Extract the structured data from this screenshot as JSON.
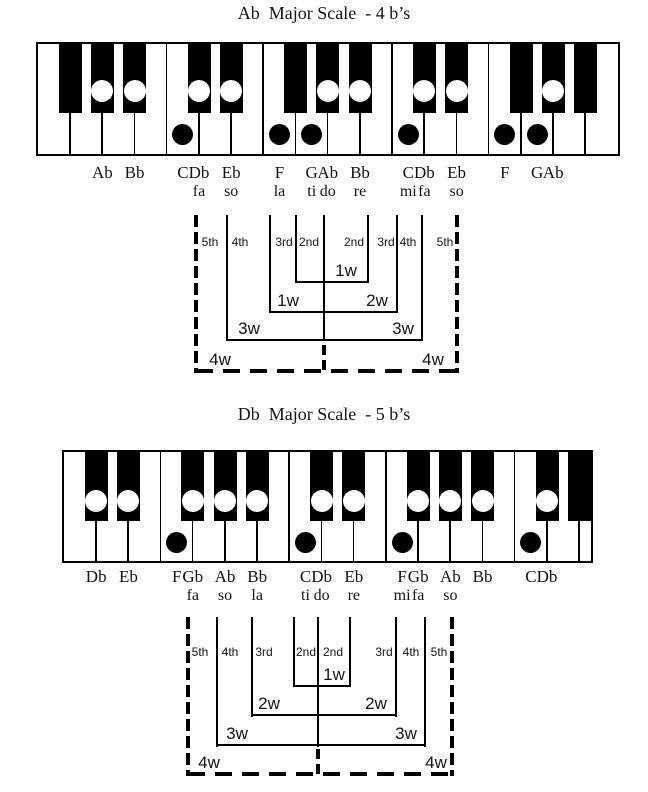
{
  "page": {
    "width": 648,
    "height": 792,
    "background": "#ffffff",
    "ink": "#000000"
  },
  "diagrams": [
    {
      "id": "ab-major",
      "title": "Ab  Major Scale  - 4 b’s",
      "title_y": 4,
      "keyboard": {
        "x": 36,
        "y": 42,
        "width": 584,
        "height": 114,
        "white_key_width": 32.2,
        "black_key_width": 23,
        "black_key_height": 69,
        "circle_cy": 47,
        "dot_cy": 90,
        "label_y": 164,
        "solfege_y": 184,
        "white_keys": [
          {
            "note": "F"
          },
          {
            "note": "G"
          },
          {
            "note": "A"
          },
          {
            "note": "B"
          },
          {
            "note": "C",
            "dot": true,
            "label": "C"
          },
          {
            "note": "D"
          },
          {
            "note": "E"
          },
          {
            "note": "F",
            "dot": true,
            "label": "F",
            "solfege": "la"
          },
          {
            "note": "G",
            "dot": true,
            "label": "G",
            "solfege": "ti"
          },
          {
            "note": "A"
          },
          {
            "note": "B"
          },
          {
            "note": "C",
            "dot": true,
            "label": "C",
            "solfege": "mi"
          },
          {
            "note": "D"
          },
          {
            "note": "E"
          },
          {
            "note": "F",
            "dot": true,
            "label": "F"
          },
          {
            "note": "G",
            "dot": true,
            "label": "G"
          },
          {
            "note": "A"
          },
          {
            "note": "B"
          }
        ],
        "black_keys": [
          {
            "boundary": 1,
            "note": "Gb",
            "circle": false
          },
          {
            "boundary": 2,
            "note": "Ab",
            "circle": true,
            "label": "Ab"
          },
          {
            "boundary": 3,
            "note": "Bb",
            "circle": true,
            "label": "Bb"
          },
          {
            "boundary": 5,
            "note": "Db",
            "circle": true,
            "label": "Db",
            "solfege": "fa"
          },
          {
            "boundary": 6,
            "note": "Eb",
            "circle": true,
            "label": "Eb",
            "solfege": "so"
          },
          {
            "boundary": 8,
            "note": "Gb",
            "circle": false
          },
          {
            "boundary": 9,
            "note": "Ab",
            "circle": true,
            "label": "Ab",
            "solfege": "do"
          },
          {
            "boundary": 10,
            "note": "Bb",
            "circle": true,
            "label": "Bb",
            "solfege": "re"
          },
          {
            "boundary": 12,
            "note": "Db",
            "circle": true,
            "label": "Db",
            "solfege": "fa"
          },
          {
            "boundary": 13,
            "note": "Eb",
            "circle": true,
            "label": "Eb",
            "solfege": "so"
          },
          {
            "boundary": 15,
            "note": "Gb",
            "circle": false
          },
          {
            "boundary": 16,
            "note": "Ab",
            "circle": true,
            "label": "Ab"
          },
          {
            "boundary": 17,
            "note": "Bb",
            "circle": false
          }
        ]
      },
      "intervals": {
        "top": 215,
        "label_y": 236,
        "verticals": [
          {
            "x": 196,
            "to": 373,
            "dashed": true
          },
          {
            "x": 227,
            "to": 341
          },
          {
            "x": 270,
            "to": 313
          },
          {
            "x": 296,
            "to": 283
          },
          {
            "x": 324,
            "to": 341,
            "center": true
          },
          {
            "x": 368,
            "to": 283
          },
          {
            "x": 397,
            "to": 313
          },
          {
            "x": 422,
            "to": 341
          },
          {
            "x": 457,
            "to": 373,
            "dashed": true
          }
        ],
        "center_dash": {
          "x": 324,
          "from": 345,
          "to": 373
        },
        "brackets": [
          {
            "y": 282,
            "x1": 296,
            "x2": 369,
            "labels": [
              {
                "text": "1w",
                "x": 346
              }
            ]
          },
          {
            "y": 312,
            "x1": 270,
            "x2": 398,
            "labels": [
              {
                "text": "1w",
                "x": 288
              },
              {
                "text": "2w",
                "x": 377
              }
            ]
          },
          {
            "y": 340,
            "x1": 227,
            "x2": 423,
            "labels": [
              {
                "text": "3w",
                "x": 249
              },
              {
                "text": "3w",
                "x": 403
              }
            ]
          },
          {
            "y": 371,
            "x1": 196,
            "x2": 459,
            "dashed": true,
            "labels": [
              {
                "text": "4w",
                "x": 220
              },
              {
                "text": "4w",
                "x": 433
              }
            ]
          }
        ],
        "interval_labels": [
          {
            "text": "5th",
            "x": 210
          },
          {
            "text": "4th",
            "x": 240
          },
          {
            "text": "3rd",
            "x": 284
          },
          {
            "text": "2nd",
            "x": 309
          },
          {
            "text": "2nd",
            "x": 354
          },
          {
            "text": "3rd",
            "x": 386
          },
          {
            "text": "4th",
            "x": 408
          },
          {
            "text": "5th",
            "x": 445
          }
        ]
      }
    },
    {
      "id": "db-major",
      "title": "Db  Major Scale  - 5 b’s",
      "title_y": 405,
      "keyboard": {
        "x": 62,
        "y": 450,
        "width": 531,
        "height": 113,
        "white_key_width": 32.2,
        "black_key_width": 23,
        "black_key_height": 69,
        "circle_cy": 49,
        "dot_cy": 90,
        "label_y": 568,
        "solfege_y": 588,
        "white_keys": [
          {
            "note": "C"
          },
          {
            "note": "D"
          },
          {
            "note": "E"
          },
          {
            "note": "F",
            "dot": true,
            "label": "F"
          },
          {
            "note": "G"
          },
          {
            "note": "A"
          },
          {
            "note": "B"
          },
          {
            "note": "C",
            "dot": true,
            "label": "C",
            "solfege": "ti"
          },
          {
            "note": "D"
          },
          {
            "note": "E"
          },
          {
            "note": "F",
            "dot": true,
            "label": "F",
            "solfege": "mi"
          },
          {
            "note": "G"
          },
          {
            "note": "A"
          },
          {
            "note": "B"
          },
          {
            "note": "C",
            "dot": true,
            "label": "C"
          },
          {
            "note": "D"
          },
          {
            "note": "E"
          }
        ],
        "black_keys": [
          {
            "boundary": 1,
            "note": "Db",
            "circle": true,
            "label": "Db"
          },
          {
            "boundary": 2,
            "note": "Eb",
            "circle": true,
            "label": "Eb"
          },
          {
            "boundary": 4,
            "note": "Gb",
            "circle": true,
            "label": "Gb",
            "solfege": "fa"
          },
          {
            "boundary": 5,
            "note": "Ab",
            "circle": true,
            "label": "Ab",
            "solfege": "so"
          },
          {
            "boundary": 6,
            "note": "Bb",
            "circle": true,
            "label": "Bb",
            "solfege": "la"
          },
          {
            "boundary": 8,
            "note": "Db",
            "circle": true,
            "label": "Db",
            "solfege": "do"
          },
          {
            "boundary": 9,
            "note": "Eb",
            "circle": true,
            "label": "Eb",
            "solfege": "re"
          },
          {
            "boundary": 11,
            "note": "Gb",
            "circle": true,
            "label": "Gb",
            "solfege": "fa"
          },
          {
            "boundary": 12,
            "note": "Ab",
            "circle": true,
            "label": "Ab",
            "solfege": "so"
          },
          {
            "boundary": 13,
            "note": "Bb",
            "circle": true,
            "label": "Bb"
          },
          {
            "boundary": 15,
            "note": "Db",
            "circle": true,
            "label": "Db"
          },
          {
            "boundary": 16,
            "note": "Eb",
            "circle": false
          }
        ]
      },
      "intervals": {
        "top": 617,
        "label_y": 646,
        "verticals": [
          {
            "x": 188,
            "to": 776,
            "dashed": true
          },
          {
            "x": 217,
            "to": 747
          },
          {
            "x": 252,
            "to": 717
          },
          {
            "x": 294,
            "to": 687
          },
          {
            "x": 318,
            "to": 747,
            "center": true
          },
          {
            "x": 350,
            "to": 687
          },
          {
            "x": 396,
            "to": 717
          },
          {
            "x": 425,
            "to": 747
          },
          {
            "x": 452,
            "to": 776,
            "dashed": true
          }
        ],
        "center_dash": {
          "x": 318,
          "from": 749,
          "to": 776
        },
        "brackets": [
          {
            "y": 686,
            "x1": 294,
            "x2": 351,
            "labels": [
              {
                "text": "1w",
                "x": 334
              }
            ]
          },
          {
            "y": 715,
            "x1": 252,
            "x2": 397,
            "labels": [
              {
                "text": "2w",
                "x": 269
              },
              {
                "text": "2w",
                "x": 376
              }
            ]
          },
          {
            "y": 745,
            "x1": 217,
            "x2": 426,
            "labels": [
              {
                "text": "3w",
                "x": 237
              },
              {
                "text": "3w",
                "x": 406
              }
            ]
          },
          {
            "y": 774,
            "x1": 188,
            "x2": 454,
            "dashed": true,
            "labels": [
              {
                "text": "4w",
                "x": 209
              },
              {
                "text": "4w",
                "x": 436
              }
            ]
          }
        ],
        "interval_labels": [
          {
            "text": "5th",
            "x": 200
          },
          {
            "text": "4th",
            "x": 230
          },
          {
            "text": "3rd",
            "x": 264
          },
          {
            "text": "2nd",
            "x": 306
          },
          {
            "text": "2nd",
            "x": 333
          },
          {
            "text": "3rd",
            "x": 384
          },
          {
            "text": "4th",
            "x": 411
          },
          {
            "text": "5th",
            "x": 439
          }
        ]
      }
    }
  ]
}
